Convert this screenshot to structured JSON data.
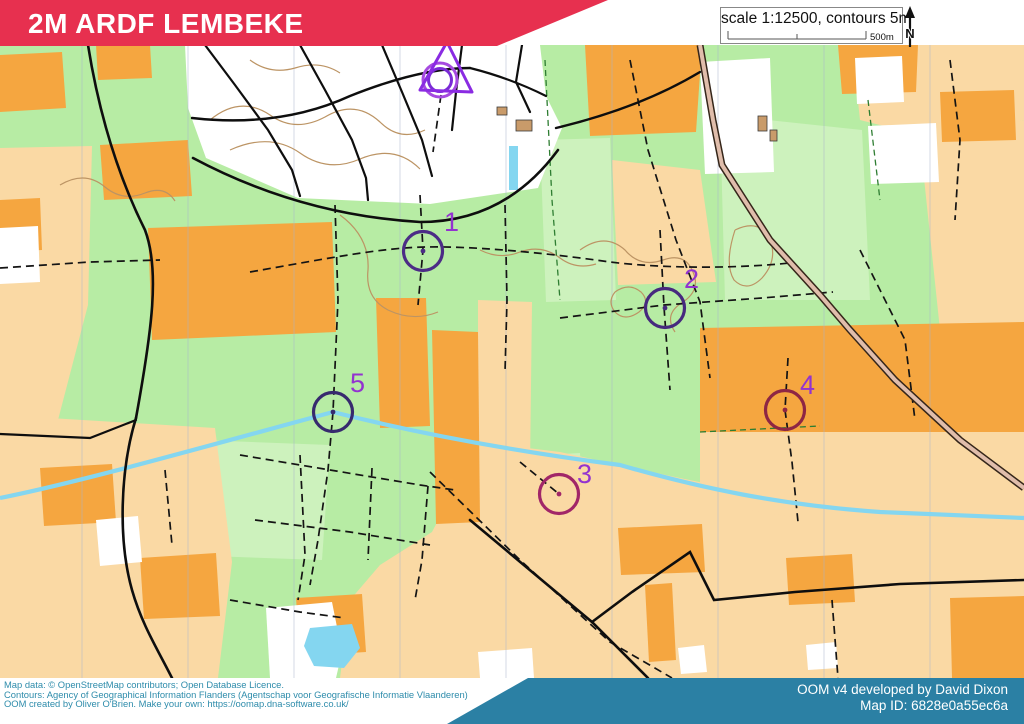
{
  "header": {
    "title": "2M ARDF LEMBEKE",
    "scale_text": "scale 1:12500, contours 5m",
    "scale_bar_label": "500m",
    "north_label": "N"
  },
  "map": {
    "start": {
      "x": 441,
      "y": 78
    },
    "controls": [
      {
        "number": "1",
        "cx": 423,
        "cy": 251,
        "lx": 444,
        "ly": 231,
        "circle_color": "#4c2c86"
      },
      {
        "number": "2",
        "cx": 665,
        "cy": 308,
        "lx": 684,
        "ly": 288,
        "circle_color": "#46297e"
      },
      {
        "number": "3",
        "cx": 559,
        "cy": 494,
        "lx": 577,
        "ly": 483,
        "circle_color": "#a12668"
      },
      {
        "number": "4",
        "cx": 785,
        "cy": 410,
        "lx": 800,
        "ly": 394,
        "circle_color": "#8e2644"
      },
      {
        "number": "5",
        "cx": 333,
        "cy": 412,
        "lx": 350,
        "ly": 392,
        "circle_color": "#372a6e"
      }
    ]
  },
  "footer": {
    "attribution_lines": [
      "Map data: © OpenStreetMap contributors; Open Database Licence.",
      "Contours: Agency of Geographical Information Flanders (Agentschap voor Geografische Informatie Vlaanderen)",
      "OOM created by Oliver O'Brien. Make your own: https://oomap.dna-software.co.uk/"
    ],
    "credit_line1": "OOM v4 developed by David Dixon",
    "credit_line2": "Map ID: 6828e0a55ec6a"
  },
  "colors": {
    "banner": "#e7304f",
    "teal": "#2b80a4",
    "green": "#b7eca4",
    "green_light": "#cdf2bd",
    "orange": "#f5a640",
    "pale_orange": "#fad9a4",
    "white_area": "#ffffff",
    "stream": "#84d6f0",
    "contour": "#bc9464",
    "road_fill": "#e0bdab",
    "road_casing": "#35261a",
    "path_black": "#141414",
    "veg_boundary": "#2e7d32",
    "grid": "#a8b4cc",
    "purple_label": "#9333cf",
    "start_outer": "#a64ae0",
    "start_inner": "#7b2bd6",
    "start_triangle": "#8a2be2",
    "building": "#c99b6a"
  }
}
